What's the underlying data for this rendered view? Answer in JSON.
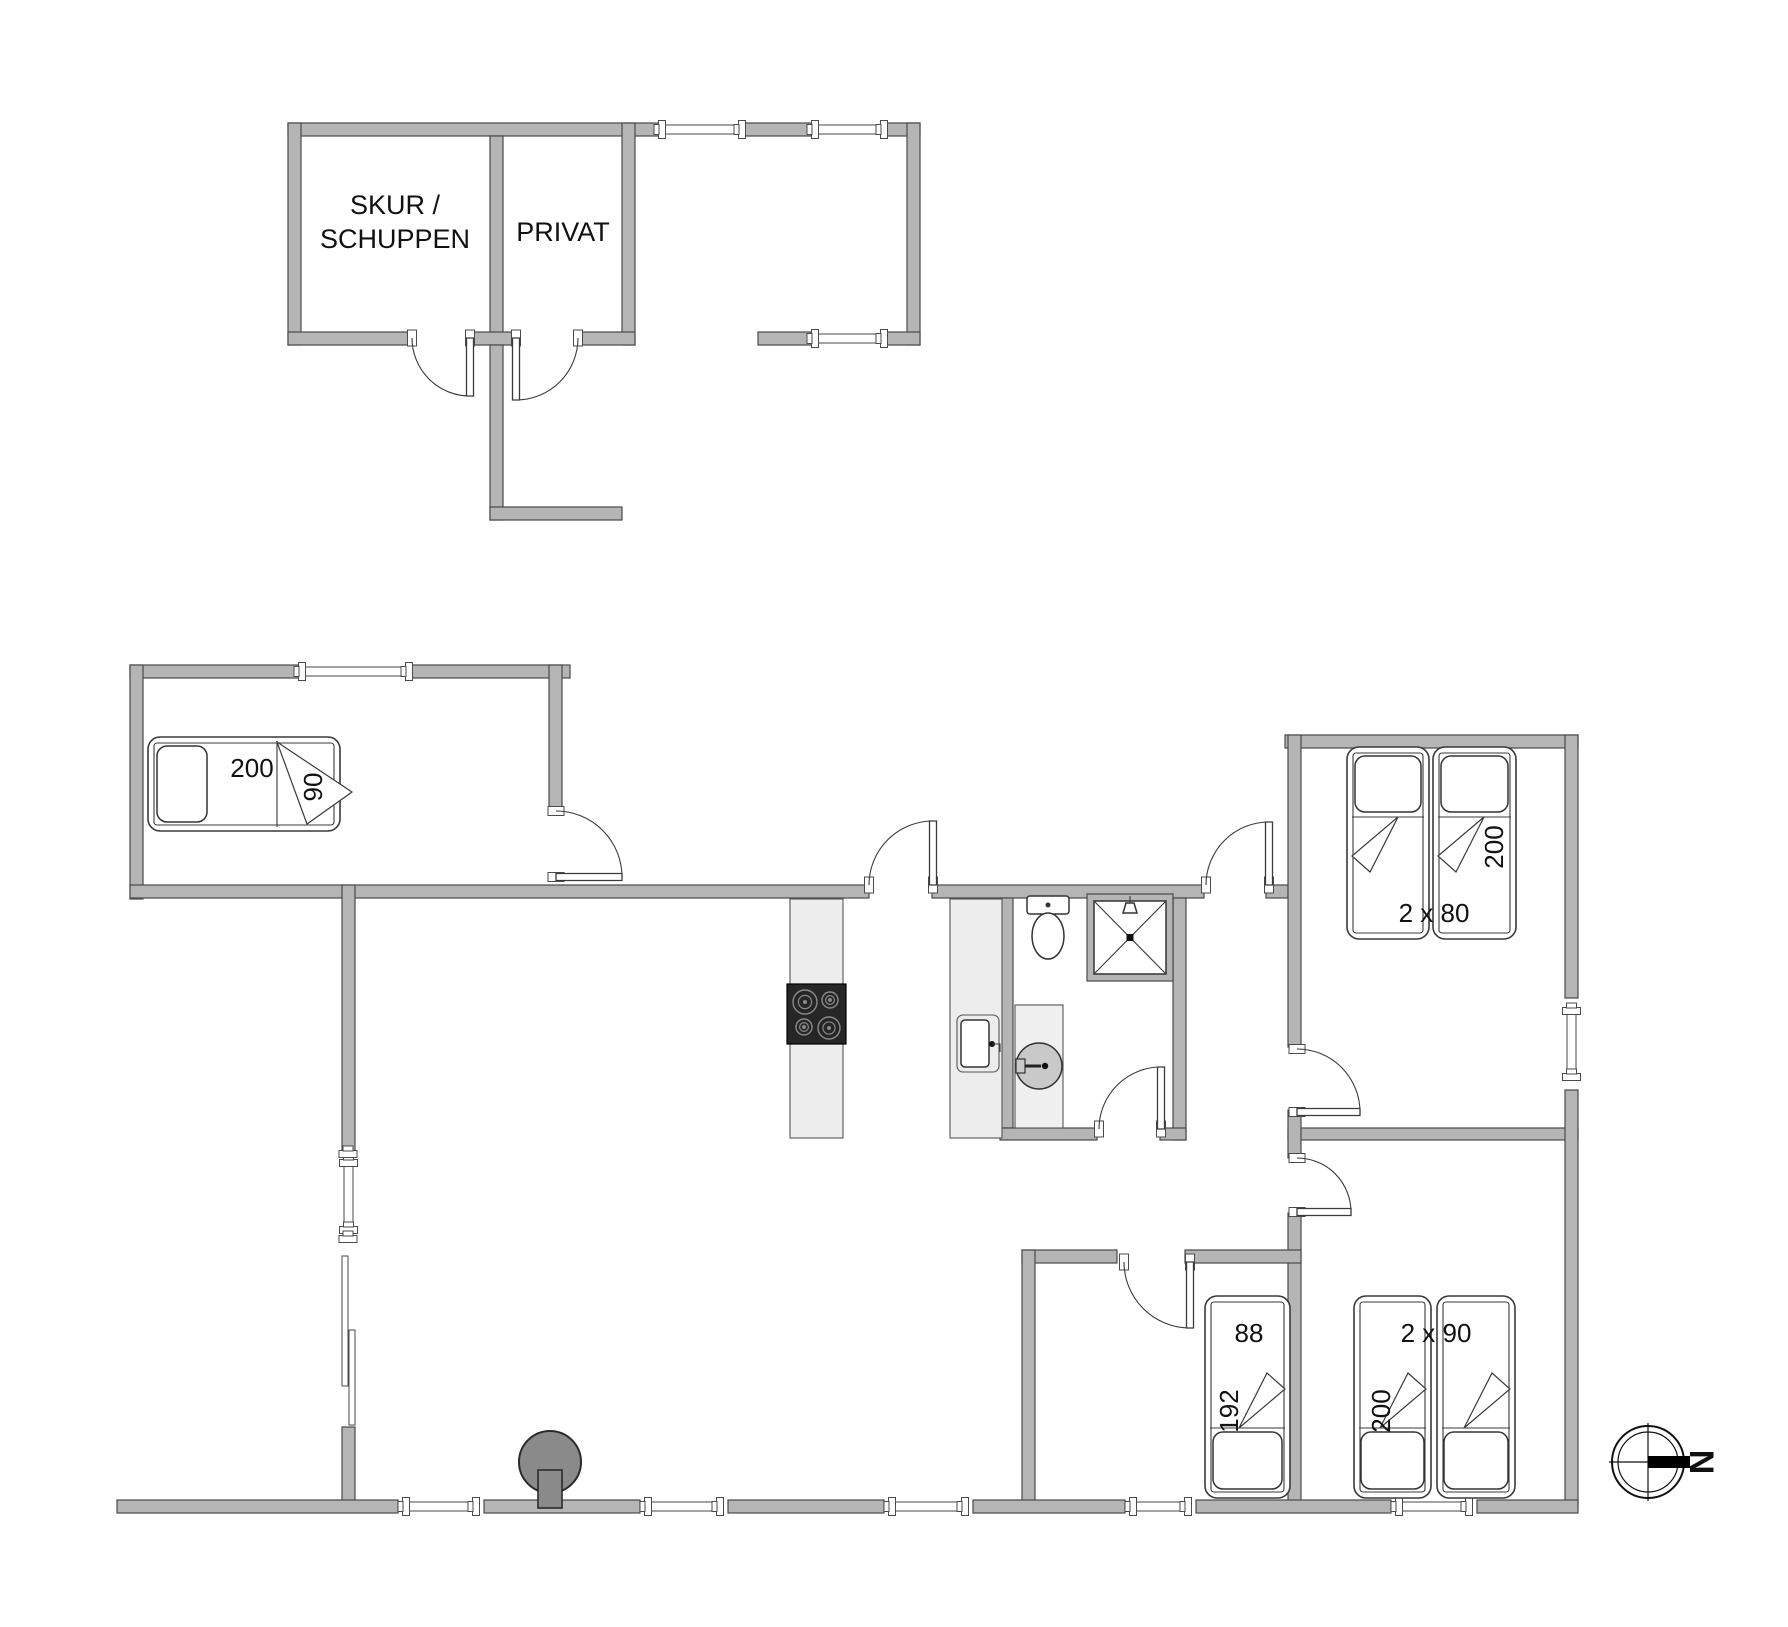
{
  "plan": {
    "width": 1788,
    "height": 1627,
    "wall_color": "#b5b5b5",
    "wall_edge_color": "#4a4a4a",
    "counter_color": "#ededed",
    "stove_color": "#8a8a8a",
    "cooktop_color": "#262626"
  },
  "rooms": {
    "shed_label_line1": "SKUR /",
    "shed_label_line2": "SCHUPPEN",
    "private_label": "PRIVAT"
  },
  "walls": [
    {
      "n": "outbuilding-top-wall-1",
      "x": 288,
      "y": 123,
      "w": 374,
      "h": 13
    },
    {
      "n": "outbuilding-top-wall-2",
      "x": 742,
      "y": 123,
      "w": 73,
      "h": 13
    },
    {
      "n": "outbuilding-top-wall-3",
      "x": 884,
      "y": 123,
      "w": 36,
      "h": 13
    },
    {
      "n": "outbuilding-left-wall",
      "x": 288,
      "y": 123,
      "w": 13,
      "h": 222
    },
    {
      "n": "shed-private-divider-wall",
      "x": 490,
      "y": 136,
      "w": 13,
      "h": 209
    },
    {
      "n": "private-right-wall",
      "x": 622,
      "y": 123,
      "w": 13,
      "h": 222
    },
    {
      "n": "carport-right-wall",
      "x": 907,
      "y": 123,
      "w": 13,
      "h": 222
    },
    {
      "n": "outbuilding-bottom-wall-1",
      "x": 288,
      "y": 332,
      "w": 124,
      "h": 13
    },
    {
      "n": "outbuilding-bottom-wall-2",
      "x": 468,
      "y": 332,
      "w": 47,
      "h": 13
    },
    {
      "n": "outbuilding-bottom-wall-3",
      "x": 577,
      "y": 332,
      "w": 58,
      "h": 13
    },
    {
      "n": "carport-bottom-wall",
      "x": 758,
      "y": 332,
      "w": 57,
      "h": 13
    },
    {
      "n": "carport-bottom-corner",
      "x": 884,
      "y": 332,
      "w": 36,
      "h": 13
    },
    {
      "n": "entry-spur-wall-vertical",
      "x": 490,
      "y": 345,
      "w": 13,
      "h": 175
    },
    {
      "n": "entry-spur-wall-horizontal",
      "x": 490,
      "y": 507,
      "w": 132,
      "h": 13
    },
    {
      "n": "nw-bedroom-top-wall-1",
      "x": 130,
      "y": 665,
      "w": 172,
      "h": 13
    },
    {
      "n": "nw-bedroom-top-wall-2",
      "x": 409,
      "y": 665,
      "w": 161,
      "h": 13
    },
    {
      "n": "nw-bedroom-left-wall",
      "x": 130,
      "y": 665,
      "w": 13,
      "h": 234
    },
    {
      "n": "nw-bedroom-right-wall",
      "x": 549,
      "y": 665,
      "w": 13,
      "h": 143
    },
    {
      "n": "north-wall-1",
      "x": 130,
      "y": 885,
      "w": 739,
      "h": 13
    },
    {
      "n": "north-wall-2",
      "x": 932,
      "y": 885,
      "w": 272,
      "h": 13
    },
    {
      "n": "north-wall-3",
      "x": 1266,
      "y": 885,
      "w": 22,
      "h": 13
    },
    {
      "n": "ne-bedroom-top-wall",
      "x": 1285,
      "y": 735,
      "w": 293,
      "h": 13
    },
    {
      "n": "west-wall-1",
      "x": 342,
      "y": 885,
      "w": 13,
      "h": 267
    },
    {
      "n": "west-wall-2",
      "x": 342,
      "y": 1427,
      "w": 13,
      "h": 79
    },
    {
      "n": "kitchen-bath-wall",
      "x": 1000,
      "y": 898,
      "w": 13,
      "h": 230
    },
    {
      "n": "bath-east-wall",
      "x": 1173,
      "y": 898,
      "w": 13,
      "h": 242
    },
    {
      "n": "bath-south-wall-1",
      "x": 1000,
      "y": 1128,
      "w": 97,
      "h": 12
    },
    {
      "n": "bath-south-wall-2",
      "x": 1160,
      "y": 1128,
      "w": 26,
      "h": 12
    },
    {
      "n": "ne-bedroom-south-wall",
      "x": 1288,
      "y": 1128,
      "w": 290,
      "h": 12
    },
    {
      "n": "bedrooms-divider-wall-1",
      "x": 1288,
      "y": 735,
      "w": 13,
      "h": 312
    },
    {
      "n": "bedrooms-divider-wall-2",
      "x": 1288,
      "y": 1110,
      "w": 13,
      "h": 48
    },
    {
      "n": "bedrooms-divider-wall-3",
      "x": 1288,
      "y": 1213,
      "w": 13,
      "h": 293
    },
    {
      "n": "hall-south-wall-1",
      "x": 1022,
      "y": 1250,
      "w": 95,
      "h": 13
    },
    {
      "n": "hall-south-wall-2",
      "x": 1185,
      "y": 1250,
      "w": 116,
      "h": 13
    },
    {
      "n": "sw-bedroom-left-wall",
      "x": 1022,
      "y": 1250,
      "w": 13,
      "h": 256
    },
    {
      "n": "east-wall-1",
      "x": 1565,
      "y": 735,
      "w": 13,
      "h": 263
    },
    {
      "n": "east-wall-2",
      "x": 1565,
      "y": 1090,
      "w": 13,
      "h": 416
    },
    {
      "n": "south-wall-1",
      "x": 117,
      "y": 1500,
      "w": 281,
      "h": 13
    },
    {
      "n": "south-wall-2",
      "x": 484,
      "y": 1500,
      "w": 156,
      "h": 13
    },
    {
      "n": "south-wall-3",
      "x": 728,
      "y": 1500,
      "w": 156,
      "h": 13
    },
    {
      "n": "south-wall-4",
      "x": 973,
      "y": 1500,
      "w": 152,
      "h": 13
    },
    {
      "n": "south-wall-5",
      "x": 1196,
      "y": 1500,
      "w": 195,
      "h": 13
    },
    {
      "n": "south-wall-6",
      "x": 1477,
      "y": 1500,
      "w": 101,
      "h": 13
    }
  ],
  "windows": [
    {
      "n": "carport-window-1",
      "x": 662,
      "y": 125,
      "w": 80,
      "h": 9,
      "o": "h"
    },
    {
      "n": "carport-window-2",
      "x": 815,
      "y": 125,
      "w": 69,
      "h": 9,
      "o": "h"
    },
    {
      "n": "carport-window-3",
      "x": 815,
      "y": 334,
      "w": 69,
      "h": 9,
      "o": "h"
    },
    {
      "n": "nw-bedroom-window",
      "x": 302,
      "y": 667,
      "w": 107,
      "h": 9,
      "o": "h"
    },
    {
      "n": "west-window",
      "x": 344,
      "y": 1163,
      "w": 9,
      "h": 67,
      "o": "v"
    },
    {
      "n": "east-window",
      "x": 1567,
      "y": 1011,
      "w": 9,
      "h": 66,
      "o": "v"
    },
    {
      "n": "south-window-1",
      "x": 406,
      "y": 1502,
      "w": 70,
      "h": 9,
      "o": "h"
    },
    {
      "n": "south-window-2",
      "x": 648,
      "y": 1502,
      "w": 72,
      "h": 9,
      "o": "h"
    },
    {
      "n": "south-window-3",
      "x": 892,
      "y": 1502,
      "w": 73,
      "h": 9,
      "o": "h"
    },
    {
      "n": "south-window-4",
      "x": 1133,
      "y": 1502,
      "w": 55,
      "h": 9,
      "o": "h"
    },
    {
      "n": "south-window-5",
      "x": 1399,
      "y": 1502,
      "w": 70,
      "h": 9,
      "o": "h"
    }
  ],
  "slider": {
    "n": "patio-sliding-door",
    "panels": [
      [
        342,
        1256,
        6,
        130
      ],
      [
        349,
        1330,
        6,
        95
      ]
    ],
    "connectors": [
      [
        348,
        1154
      ],
      [
        348,
        1239
      ]
    ]
  },
  "doors": [
    {
      "n": "shed-door",
      "hx": 470,
      "hy": 338,
      "r": 58,
      "leaf": 90,
      "close": 180,
      "sweep": 1,
      "wall": "h"
    },
    {
      "n": "private-door",
      "hx": 516,
      "hy": 338,
      "r": 62,
      "leaf": 90,
      "close": 0,
      "sweep": 0,
      "wall": "h"
    },
    {
      "n": "nw-bedroom-door",
      "hx": 556,
      "hy": 877,
      "r": 66,
      "leaf": 0,
      "close": 270,
      "sweep": 0,
      "wall": "v"
    },
    {
      "n": "entry-door",
      "hx": 933,
      "hy": 885,
      "r": 64,
      "leaf": 270,
      "close": 180,
      "sweep": 0,
      "wall": "h"
    },
    {
      "n": "hall-entry-door",
      "hx": 1269,
      "hy": 885,
      "r": 63,
      "leaf": 270,
      "close": 180,
      "sweep": 0,
      "wall": "h"
    },
    {
      "n": "bathroom-door",
      "hx": 1161,
      "hy": 1129,
      "r": 62,
      "leaf": 270,
      "close": 180,
      "sweep": 0,
      "wall": "h"
    },
    {
      "n": "ne-bedroom-door",
      "hx": 1297,
      "hy": 1112,
      "r": 63,
      "leaf": 0,
      "close": 270,
      "sweep": 0,
      "wall": "v"
    },
    {
      "n": "se-bedroom-door",
      "hx": 1297,
      "hy": 1212,
      "r": 54,
      "leaf": 0,
      "close": 270,
      "sweep": 0,
      "wall": "v"
    },
    {
      "n": "sw-bedroom-door",
      "hx": 1190,
      "hy": 1262,
      "r": 66,
      "leaf": 90,
      "close": 180,
      "sweep": 1,
      "wall": "h"
    }
  ],
  "beds": [
    {
      "n": "bed-nw-single",
      "x": 148,
      "y": 737,
      "w": 192,
      "h": 94,
      "pillow": [
        157,
        746,
        50,
        76
      ],
      "sheet": [
        277,
        741,
        277,
        827
      ],
      "fold": [
        [
          277,
          742
        ],
        [
          307,
          824
        ],
        [
          352,
          792
        ]
      ]
    },
    {
      "n": "bed-ne-twin-1",
      "x": 1347,
      "y": 747,
      "w": 82,
      "h": 192,
      "pillow": [
        1355,
        756,
        66,
        56
      ],
      "sheet": [
        1352,
        817,
        1424,
        817
      ],
      "fold": [
        [
          1398,
          817
        ],
        [
          1352,
          856
        ],
        [
          1370,
          872
        ]
      ]
    },
    {
      "n": "bed-ne-twin-2",
      "x": 1433,
      "y": 747,
      "w": 83,
      "h": 192,
      "pillow": [
        1441,
        756,
        67,
        56
      ],
      "sheet": [
        1438,
        817,
        1511,
        817
      ],
      "fold": [
        [
          1484,
          817
        ],
        [
          1438,
          856
        ],
        [
          1456,
          872
        ]
      ]
    },
    {
      "n": "bed-sw-single",
      "x": 1205,
      "y": 1296,
      "w": 85,
      "h": 202,
      "pillow": [
        1213,
        1432,
        69,
        57
      ],
      "sheet": [
        1210,
        1428,
        1285,
        1428
      ],
      "fold": [
        [
          1239,
          1428
        ],
        [
          1285,
          1389
        ],
        [
          1267,
          1373
        ]
      ]
    },
    {
      "n": "bed-se-twin-1",
      "x": 1354,
      "y": 1296,
      "w": 77,
      "h": 202,
      "pillow": [
        1361,
        1432,
        63,
        57
      ],
      "sheet": [
        1359,
        1428,
        1426,
        1428
      ],
      "fold": [
        [
          1380,
          1428
        ],
        [
          1426,
          1389
        ],
        [
          1408,
          1373
        ]
      ]
    },
    {
      "n": "bed-se-twin-2",
      "x": 1437,
      "y": 1296,
      "w": 78,
      "h": 202,
      "pillow": [
        1444,
        1432,
        64,
        57
      ],
      "sheet": [
        1442,
        1428,
        1510,
        1428
      ],
      "fold": [
        [
          1464,
          1428
        ],
        [
          1510,
          1389
        ],
        [
          1492,
          1373
        ]
      ]
    }
  ],
  "labels": [
    {
      "n": "shed-label-1",
      "t": "SKUR /",
      "x": 395,
      "y": 205,
      "s": 27
    },
    {
      "n": "shed-label-2",
      "t": "SCHUPPEN",
      "x": 395,
      "y": 239,
      "s": 27
    },
    {
      "n": "private-label",
      "t": "PRIVAT",
      "x": 563,
      "y": 232,
      "s": 27
    },
    {
      "n": "nw-bed-length-label",
      "t": "200",
      "x": 252,
      "y": 768,
      "s": 26
    },
    {
      "n": "nw-bed-width-label",
      "t": "90",
      "x": 313,
      "y": 787,
      "s": 26,
      "r": -90
    },
    {
      "n": "ne-bed-length-label",
      "t": "200",
      "x": 1494,
      "y": 847,
      "s": 26,
      "r": -90
    },
    {
      "n": "ne-bed-width-label",
      "t": "2 x 80",
      "x": 1434,
      "y": 913,
      "s": 26
    },
    {
      "n": "sw-bed-width-label",
      "t": "88",
      "x": 1249,
      "y": 1333,
      "s": 26
    },
    {
      "n": "sw-bed-length-label",
      "t": "192",
      "x": 1229,
      "y": 1411,
      "s": 26,
      "r": -90
    },
    {
      "n": "se-bed-width-label",
      "t": "2 x 90",
      "x": 1436,
      "y": 1333,
      "s": 26
    },
    {
      "n": "se-bed-length-label",
      "t": "200",
      "x": 1381,
      "y": 1411,
      "s": 26,
      "r": -90
    }
  ],
  "fixtures": {
    "kitchen_island": {
      "x": 790,
      "y": 899,
      "w": 53,
      "h": 239
    },
    "cooktop": {
      "x": 787,
      "y": 984,
      "w": 59,
      "h": 60,
      "burners": [
        [
          805,
          1002,
          12
        ],
        [
          830,
          1000,
          8
        ],
        [
          804,
          1027,
          8
        ],
        [
          829,
          1028,
          11
        ]
      ]
    },
    "kitchen_counter": {
      "x": 950,
      "y": 899,
      "w": 52,
      "h": 239
    },
    "kitchen_sink": {
      "x": 957,
      "y": 1015,
      "w": 42,
      "h": 57
    },
    "toilet": {
      "tank": [
        1027,
        896,
        42,
        18
      ],
      "bowl": [
        1048,
        936,
        16,
        23
      ]
    },
    "shower": {
      "x": 1087,
      "y": 894,
      "w": 86,
      "h": 87
    },
    "vanity": {
      "x": 1015,
      "y": 1005,
      "w": 48,
      "h": 123
    },
    "wash_basin": {
      "cx": 1039,
      "cy": 1066,
      "r": 23
    },
    "wood_stove": {
      "cx": 550,
      "cy": 1462,
      "r": 31,
      "flue": [
        538,
        1470,
        24,
        38
      ]
    }
  },
  "compass": {
    "cx": 1648,
    "cy": 1462,
    "r_outer": 36,
    "r_inner": 30,
    "bar": [
      1648,
      1456,
      42,
      12
    ],
    "label": "N"
  }
}
